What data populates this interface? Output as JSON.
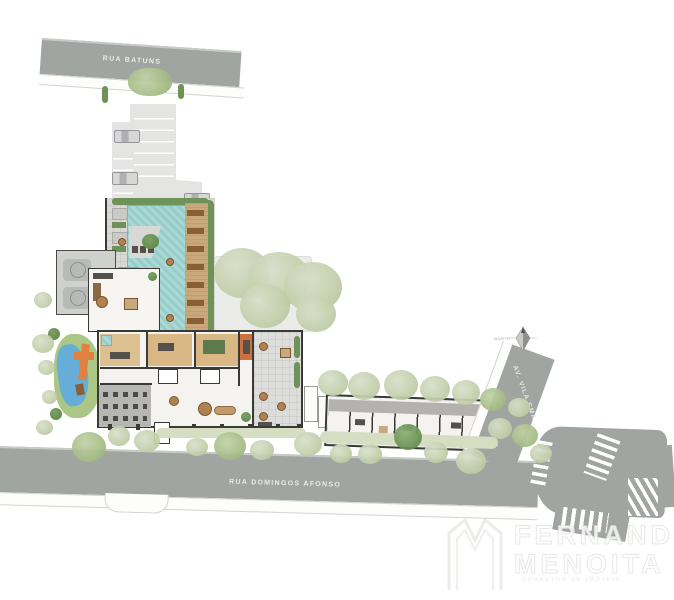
{
  "plan": {
    "streets": {
      "top": "RUA BATUNS",
      "bottom": "RUA DOMINGOS AFONSO",
      "right": "AV. VILA EMA"
    },
    "compass": {
      "label": "NORTE"
    },
    "watermark": {
      "line1": "FERNANDO",
      "line2": "MENOITA",
      "tagline": "CORRETOR DE IMÓVEIS"
    },
    "colors": {
      "street_grey": "#a1a5a2",
      "pool_teal": "#9fd2cf",
      "wood_deck": "#c9a87e",
      "landscape_green": "#c6d2ac",
      "hedge_green": "#6e9258",
      "playground_orange": "#e08140",
      "playground_water_blue": "#66aed8",
      "building_wall": "#3a3a36",
      "paving": "#d8d9d5"
    }
  }
}
